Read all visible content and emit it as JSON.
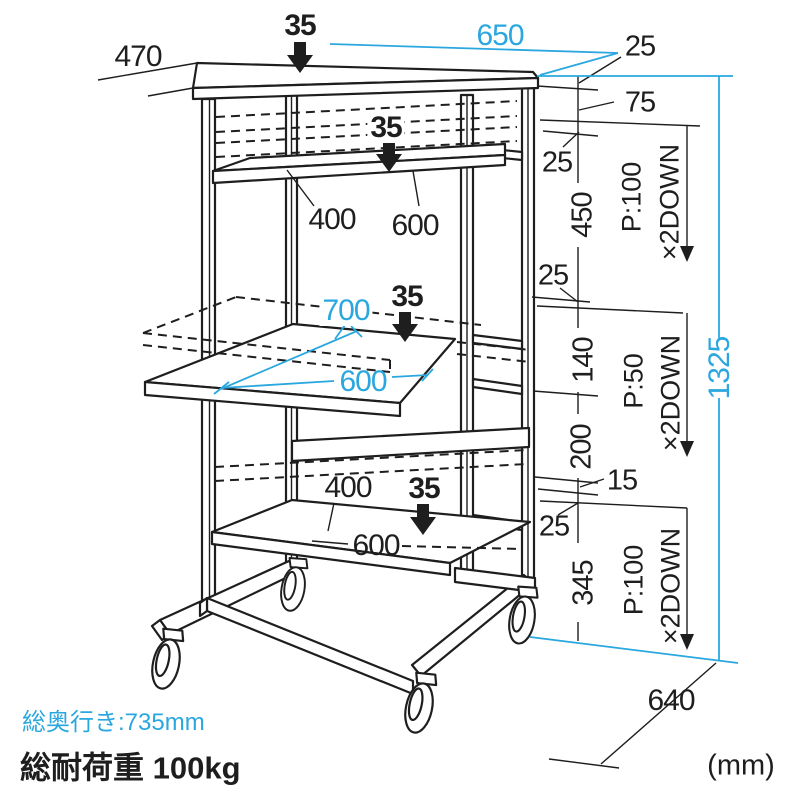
{
  "meta": {
    "description": "Dimension diagram of a three-shelf computer cart on casters",
    "unit_note": "(mm)"
  },
  "colors": {
    "accent_cyan": "#2AA7DF",
    "line_black": "#1E1E1E"
  },
  "labels": {
    "d470": "470",
    "l35a": "35",
    "d650": "650",
    "d25a": "25",
    "d75": "75",
    "d25b": "25",
    "d450": "450",
    "p100a": "P:100",
    "x2a": "×2DOWN",
    "l35b": "35",
    "d400a": "400",
    "d600a": "600",
    "d25c": "25",
    "d140": "140",
    "p50": "P:50",
    "x2b": "×2DOWN",
    "d1325": "1325",
    "d700": "700",
    "l35c": "35",
    "d600b": "600",
    "d200": "200",
    "d15": "15",
    "d25d": "25",
    "d345": "345",
    "p100b": "P:100",
    "x2c": "×2DOWN",
    "d400b": "400",
    "l35d": "35",
    "d600c": "600",
    "d640": "640",
    "unit": "(mm)",
    "total_depth": "総奥行き:735mm",
    "total_load": "総耐荷重 100kg"
  }
}
